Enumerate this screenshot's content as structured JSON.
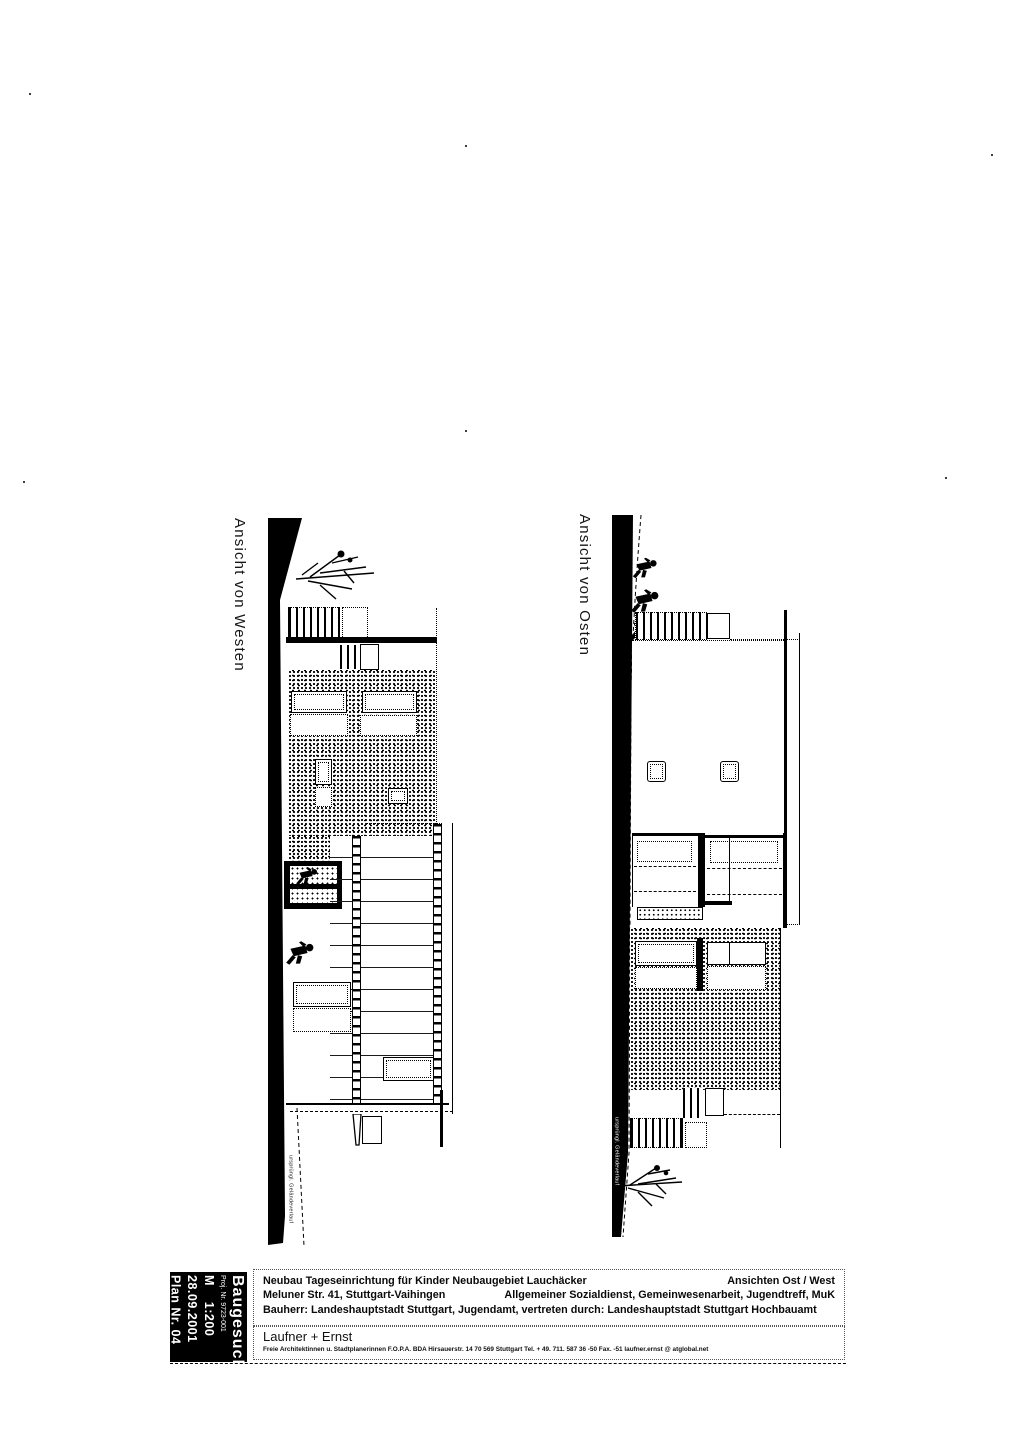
{
  "sheet": {
    "drawings": {
      "west": {
        "label": "Ansicht von Westen",
        "ground_note": "ursprüngl. Geländeverlauf"
      },
      "east": {
        "label": "Ansicht von Osten",
        "ground_note": "ursprüngl. Geländeverlauf"
      }
    },
    "title_block": {
      "stamp": {
        "title": "Baugesuch",
        "project_no": "Proj. Nr. 9723-001",
        "scale": "M    1:200",
        "date": "28.09.2001",
        "plan_no": "Plan Nr. 04"
      },
      "project": {
        "title": "Neubau Tageseinrichtung für Kinder Neubaugebiet Lauchäcker",
        "sheet_name": "Ansichten Ost / West",
        "address": "Meluner Str. 41, Stuttgart-Vaihingen",
        "usage": "Allgemeiner Sozialdienst, Gemeinwesenarbeit, Jugendtreff, MuK",
        "client": "Bauherr: Landeshauptstadt Stuttgart, Jugendamt, vertreten durch:  Landeshauptstadt Stuttgart Hochbauamt"
      },
      "architect": {
        "name": "Laufner + Ernst",
        "details": "Freie Architektinnen u. Stadtplanerinnen F.O.P.A. BDA     Hirsauerstr. 14    70 569 Stuttgart    Tel. + 49. 711. 587 36 -50  Fax. -51    laufner.ernst @ atglobal.net"
      }
    },
    "colors": {
      "ink": "#000000",
      "paper": "#ffffff"
    }
  }
}
